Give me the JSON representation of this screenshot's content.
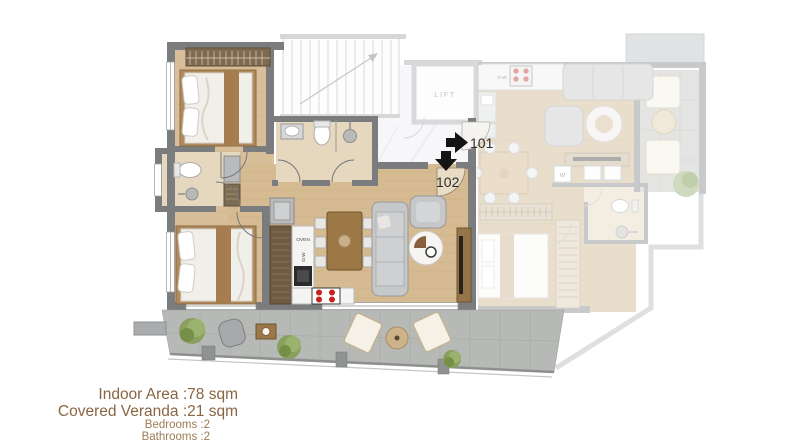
{
  "plan_labels": {
    "lift": "LIFT",
    "unit_101": "101",
    "unit_102": "102",
    "oven": "OVEN",
    "dishwasher": "D.W",
    "washer": "W"
  },
  "icons": {
    "unit_101_entry": "arrow-right-icon",
    "unit_102_entry": "arrow-down-icon"
  },
  "stats": {
    "indoor_area": {
      "label": "Indoor Area :",
      "value": "78 sqm"
    },
    "covered_veranda": {
      "label": "Covered Veranda :",
      "value": "21 sqm"
    },
    "bedrooms": {
      "label": "Bedrooms :",
      "value": "2"
    },
    "bathrooms": {
      "label": "Bathrooms :",
      "value": "2"
    }
  },
  "colors": {
    "stats_text_primary": "#8a6543",
    "stats_text_secondary": "#9d7c52",
    "wall_gray": "#7b7c7e",
    "wood_floor": "#d6bb92",
    "bathroom_tile": "#e6d8bf",
    "veranda_tile": "#b6b9b5",
    "stove_burner_red": "#c4231f",
    "label_dark": "#2e2d2b"
  }
}
